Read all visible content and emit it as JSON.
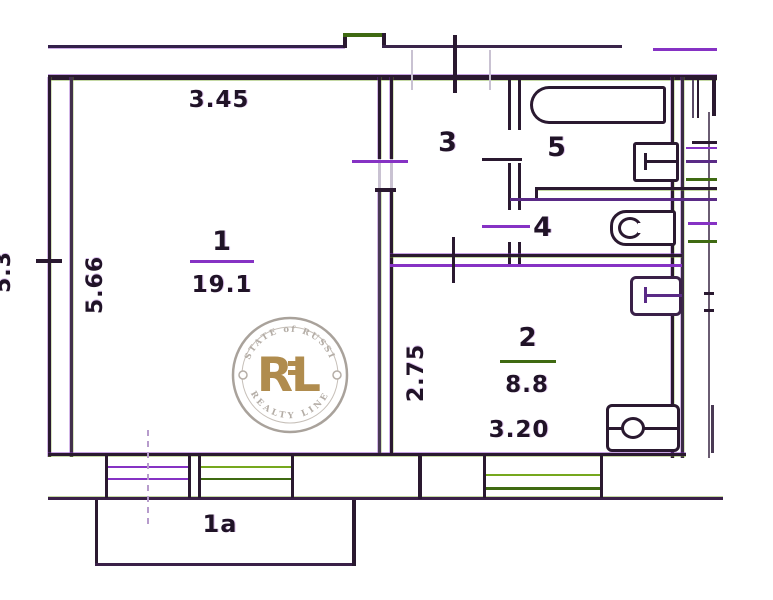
{
  "plan": {
    "rooms": {
      "living": {
        "number": "1",
        "area": "19.1",
        "width": "3.45",
        "height": "5.66"
      },
      "kitchen": {
        "number": "2",
        "area": "8.8",
        "width": "3.20",
        "height": "2.75"
      },
      "hall": {
        "number": "3"
      },
      "wc": {
        "number": "4"
      },
      "bath": {
        "number": "5"
      },
      "balcony": {
        "number": "1а"
      }
    },
    "edge_dim": "5.3",
    "fixtures": [
      "bathtub",
      "wash-sink",
      "toilet",
      "kitchen-sink",
      "stove"
    ],
    "colors": {
      "ink": "#2a1930",
      "accent_purple": "#8632c4",
      "accent_green": "#4f7a14",
      "window_green": "#76a81e",
      "gold": "#b08c4e"
    }
  },
  "watermark": {
    "initial_r": "R",
    "initial_l": "L",
    "arc_top": "ESTATE of RUSSIA",
    "arc_bottom": "REALTY LINE"
  }
}
